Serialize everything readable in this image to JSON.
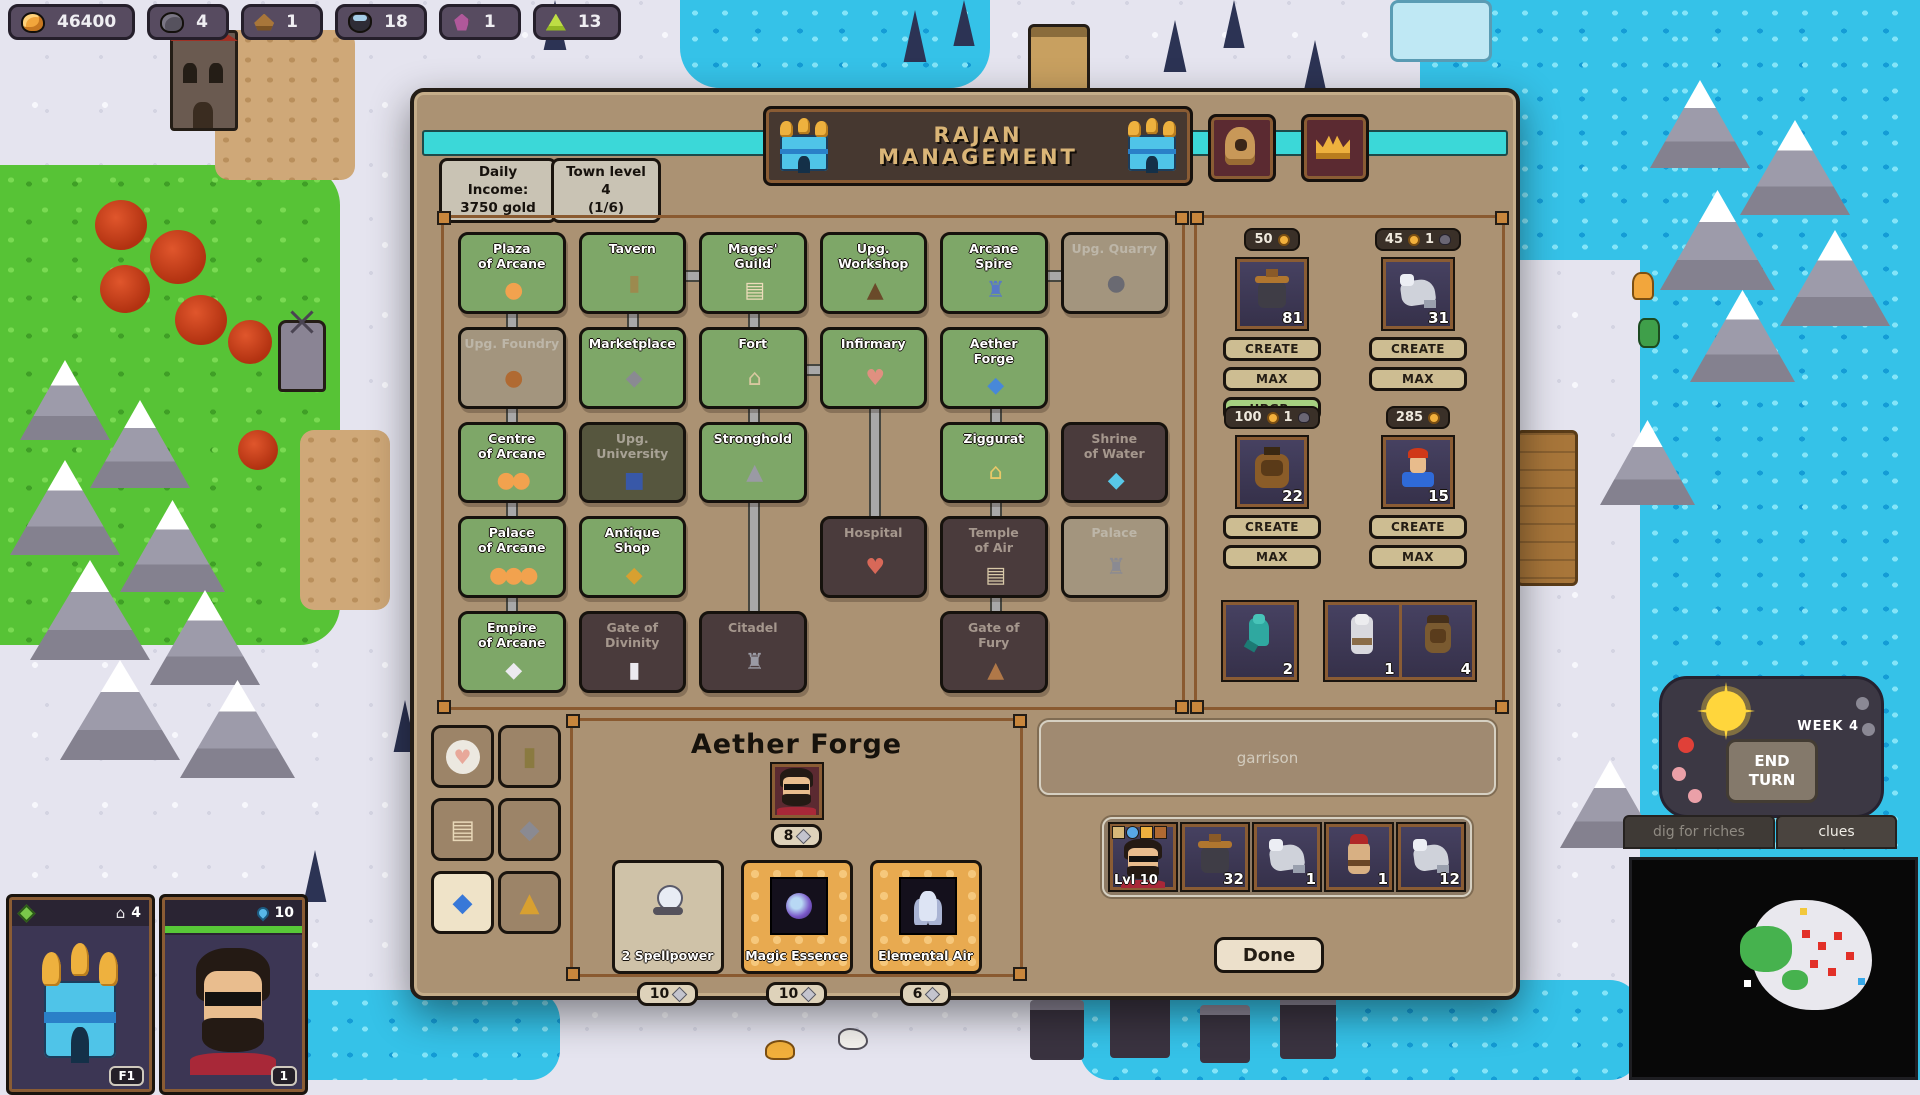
{
  "resources": {
    "gold": "46400",
    "ore": "4",
    "wood": "1",
    "mercury": "18",
    "crystal": "1",
    "gems": "13"
  },
  "dialog": {
    "title": "RAJAN\nMANAGEMENT",
    "income_box": "Daily Income:\n3750 gold",
    "level_box": "Town level 4\n(1/6)",
    "buildings": [
      {
        "name": "Plaza\nof Arcane",
        "glyph": "●",
        "glyph_color": "#f2a24e"
      },
      {
        "name": "Tavern",
        "glyph": "▮",
        "glyph_color": "#9c8a4e"
      },
      {
        "name": "Mages'\nGuild",
        "glyph": "▤",
        "glyph_color": "#ecdcba"
      },
      {
        "name": "Upg. Workshop",
        "glyph": "▲",
        "glyph_color": "#6a4a2a"
      },
      {
        "name": "Arcane\nSpire",
        "glyph": "♜",
        "glyph_color": "#5878c8"
      },
      {
        "name": "Upg. Quarry",
        "glyph": "●",
        "glyph_color": "#6a6a72"
      },
      {
        "name": "Upg. Foundry",
        "glyph": "●",
        "glyph_color": "#b06a32"
      },
      {
        "name": "Marketplace",
        "glyph": "◆",
        "glyph_color": "#8a8a92"
      },
      {
        "name": "Fort",
        "glyph": "⌂",
        "glyph_color": "#d8c8a0"
      },
      {
        "name": "Infirmary",
        "glyph": "♥",
        "glyph_color": "#e09080"
      },
      {
        "name": "Aether\nForge",
        "glyph": "◆",
        "glyph_color": "#4888d8"
      },
      {
        "name": "Centre\nof Arcane",
        "glyph": "●●",
        "glyph_color": "#f2a24e"
      },
      {
        "name": "Upg. University",
        "glyph": "■",
        "glyph_color": "#3858a8"
      },
      {
        "name": "Stronghold",
        "glyph": "▲",
        "glyph_color": "#9a9aa4"
      },
      {
        "name": "Ziggurat",
        "glyph": "⌂",
        "glyph_color": "#e8c868"
      },
      {
        "name": "Shrine\nof Water",
        "glyph": "◆",
        "glyph_color": "#58c8e8"
      },
      {
        "name": "Palace\nof Arcane",
        "glyph": "●●●",
        "glyph_color": "#f2a24e"
      },
      {
        "name": "Antique\nShop",
        "glyph": "◆",
        "glyph_color": "#d8a030"
      },
      {
        "name": "Hospital",
        "glyph": "♥",
        "glyph_color": "#d86858"
      },
      {
        "name": "Temple\nof Air",
        "glyph": "▤",
        "glyph_color": "#d8c8a8"
      },
      {
        "name": "Palace",
        "glyph": "♜",
        "glyph_color": "#8a8a92"
      },
      {
        "name": "Empire\nof Arcane",
        "glyph": "◆",
        "glyph_color": "#eceaf0"
      },
      {
        "name": "Gate of\nDivinity",
        "glyph": "▮",
        "glyph_color": "#eceaf0"
      },
      {
        "name": "Citadel",
        "glyph": "♜",
        "glyph_color": "#9a9aa4"
      },
      {
        "name": "Gate of\nFury",
        "glyph": "▲",
        "glyph_color": "#b07848"
      }
    ],
    "recruits": [
      {
        "cost_gold": "50",
        "count": "81",
        "create": "CREATE",
        "max": "MAX",
        "upgrade": "UPGR."
      },
      {
        "cost_gold": "45",
        "cost_ore": "1",
        "count": "31",
        "create": "CREATE",
        "max": "MAX"
      },
      {
        "cost_gold": "100",
        "cost_ore": "1",
        "count": "22",
        "create": "CREATE",
        "max": "MAX"
      },
      {
        "cost_gold": "285",
        "count": "15",
        "create": "CREATE",
        "max": "MAX"
      }
    ],
    "reserve_slots": [
      {
        "count": "2"
      },
      {
        "count": "1"
      },
      {
        "count": "4"
      }
    ],
    "detail": {
      "title": "Aether Forge",
      "hero_cost": "8",
      "items": [
        {
          "name": "2 Spellpower",
          "cost": "10"
        },
        {
          "name": "Magic Essence",
          "cost": "10"
        },
        {
          "name": "Elemental Air",
          "cost": "6"
        }
      ]
    },
    "garrison_label": "garrison",
    "army": {
      "hero_label": "Lvl 10",
      "counts": [
        "32",
        "1",
        "1",
        "12"
      ]
    },
    "done_label": "Done"
  },
  "hud": {
    "week_label": "WEEK 4",
    "end_turn_label": "END\nTURN",
    "dig_label": "dig for riches",
    "clues_label": "clues"
  },
  "left_panels": {
    "town": {
      "count": "4",
      "hotkey": "F1"
    },
    "hero": {
      "count": "10",
      "badge": "1"
    }
  }
}
